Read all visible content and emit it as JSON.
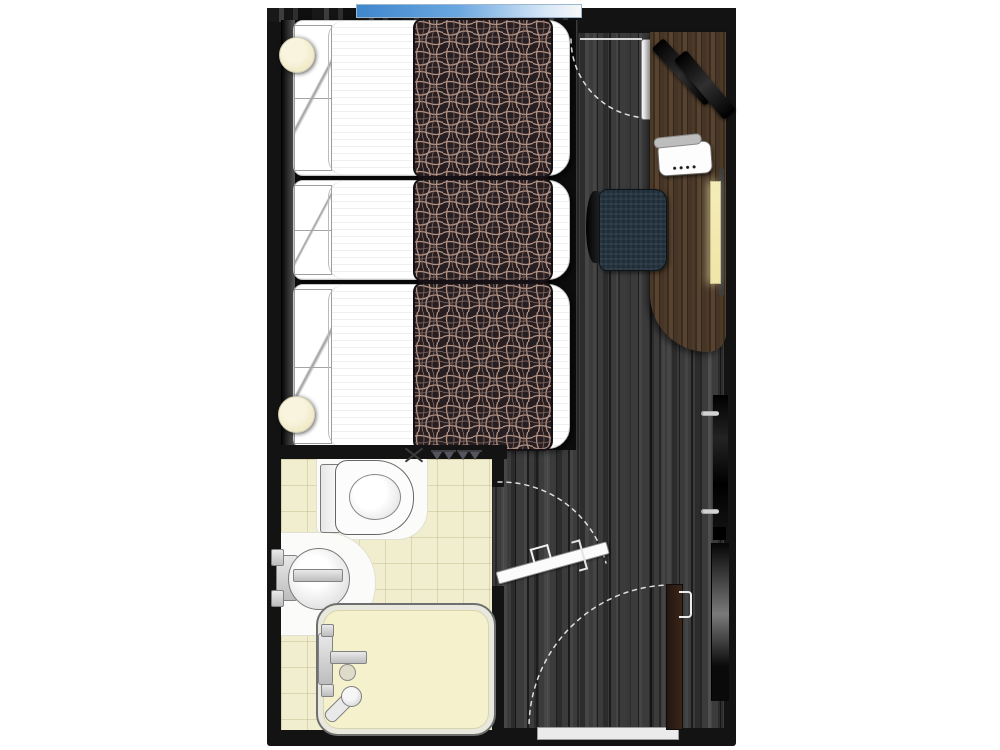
{
  "meta": {
    "title": "Hotel guest room floor plan (top-down)",
    "type": "architectural-floor-plan",
    "visible_text": "none"
  },
  "palette": {
    "wall": "#131313",
    "wood_floor": "#3b3b3b",
    "desk_wood": "#46352a",
    "bed_linen": "#ffffff",
    "runner_base": "#271e22",
    "runner_thread": "#b29283",
    "bathroom_tile": "#f1edcf",
    "bathtub_fill": "#f5f1cd",
    "window_blue": "#4f93d6",
    "lamp_cream": "#f4eecd",
    "chair_navy": "#1f2e39",
    "entry_door_brown": "#32211a",
    "swing_arc": "#e6e6e6"
  },
  "rooms": {
    "bedroom": {
      "label": "bedroom",
      "beds": [
        {
          "label": "bed 1 with patterned runner"
        },
        {
          "label": "bed 2 with patterned runner"
        },
        {
          "label": "bed 3 with patterned runner"
        }
      ],
      "furniture": [
        {
          "label": "desk"
        },
        {
          "label": "desk chair"
        },
        {
          "label": "flat-screen TV"
        },
        {
          "label": "telephone"
        },
        {
          "label": "desk lamp"
        },
        {
          "label": "wardrobe"
        },
        {
          "label": "full-length mirror"
        },
        {
          "label": "bedside lamp (head of beds)"
        },
        {
          "label": "bedside lamp (foot of beds)"
        }
      ]
    },
    "bathroom": {
      "label": "bathroom",
      "fixtures": [
        {
          "label": "toilet"
        },
        {
          "label": "round washbasin"
        },
        {
          "label": "bathtub"
        },
        {
          "label": "handheld shower"
        },
        {
          "label": "towel rack"
        },
        {
          "label": "towel rack"
        }
      ]
    },
    "openings": [
      {
        "label": "window"
      },
      {
        "label": "balcony door"
      },
      {
        "label": "bathroom door"
      },
      {
        "label": "entrance door"
      },
      {
        "label": "entrance threshold"
      }
    ]
  }
}
